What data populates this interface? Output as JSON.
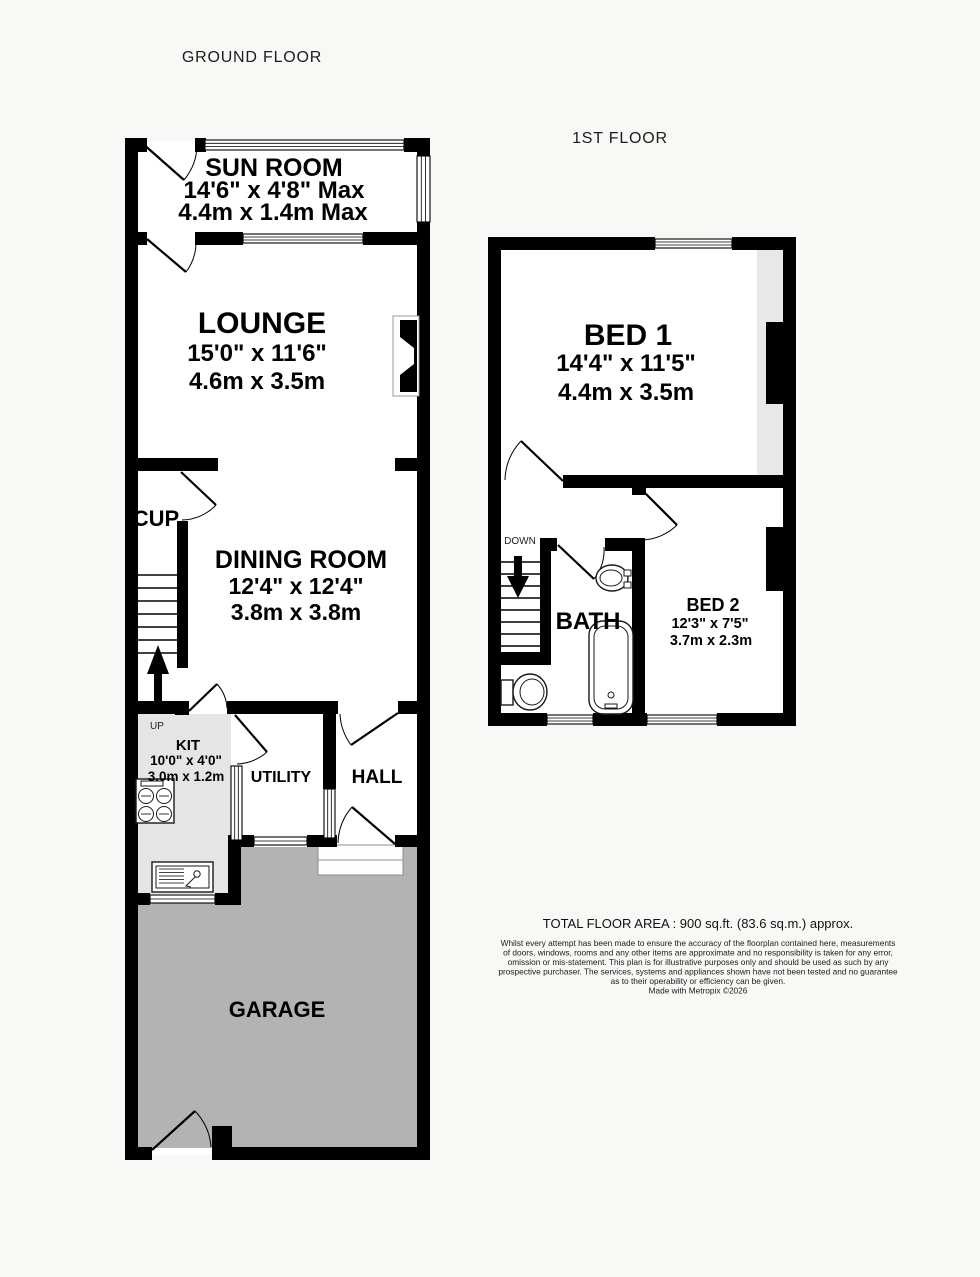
{
  "floors": {
    "ground": {
      "title": "GROUND FLOOR",
      "rooms": {
        "sun_room": {
          "name": "SUN ROOM",
          "imperial": "14'6\" x 4'8\" Max",
          "metric": "4.4m x 1.4m Max"
        },
        "lounge": {
          "name": "LOUNGE",
          "imperial": "15'0\" x 11'6\"",
          "metric": "4.6m x 3.5m"
        },
        "cup": {
          "name": "CUP"
        },
        "dining_room": {
          "name": "DINING ROOM",
          "imperial": "12'4\" x 12'4\"",
          "metric": "3.8m x 3.8m"
        },
        "kitchen": {
          "name": "KIT",
          "imperial": "10'0\" x 4'0\"",
          "metric": "3.0m x 1.2m"
        },
        "utility": {
          "name": "UTILITY"
        },
        "hall": {
          "name": "HALL"
        },
        "garage": {
          "name": "GARAGE"
        }
      },
      "stairs_label": "UP"
    },
    "first": {
      "title": "1ST FLOOR",
      "rooms": {
        "bed1": {
          "name": "BED 1",
          "imperial": "14'4\" x 11'5\"",
          "metric": "4.4m x 3.5m"
        },
        "bed2": {
          "name": "BED 2",
          "imperial": "12'3\" x 7'5\"",
          "metric": "3.7m x 2.3m"
        },
        "bath": {
          "name": "BATH"
        }
      },
      "stairs_label": "DOWN"
    }
  },
  "footer": {
    "total_area": "TOTAL FLOOR AREA : 900 sq.ft. (83.6 sq.m.) approx.",
    "disclaimer_lines": [
      "Whilst every attempt has been made to ensure the accuracy of the floorplan contained here, measurements",
      "of doors, windows, rooms and any other items are approximate and no responsibility is taken for any error,",
      "omission or mis-statement. This plan is for illustrative purposes only and should be used as such by any",
      "prospective purchaser. The services, systems and appliances shown have not been tested and no guarantee",
      "as to their operability or efficiency can be given."
    ],
    "credit": "Made with Metropix ©2026"
  },
  "colors": {
    "wall": "#000000",
    "garage_floor": "#b3b3b3",
    "kitchen_floor": "#e5e5e5",
    "wardrobe_strip": "#e8e8e8",
    "background": "#f8f8f6"
  }
}
